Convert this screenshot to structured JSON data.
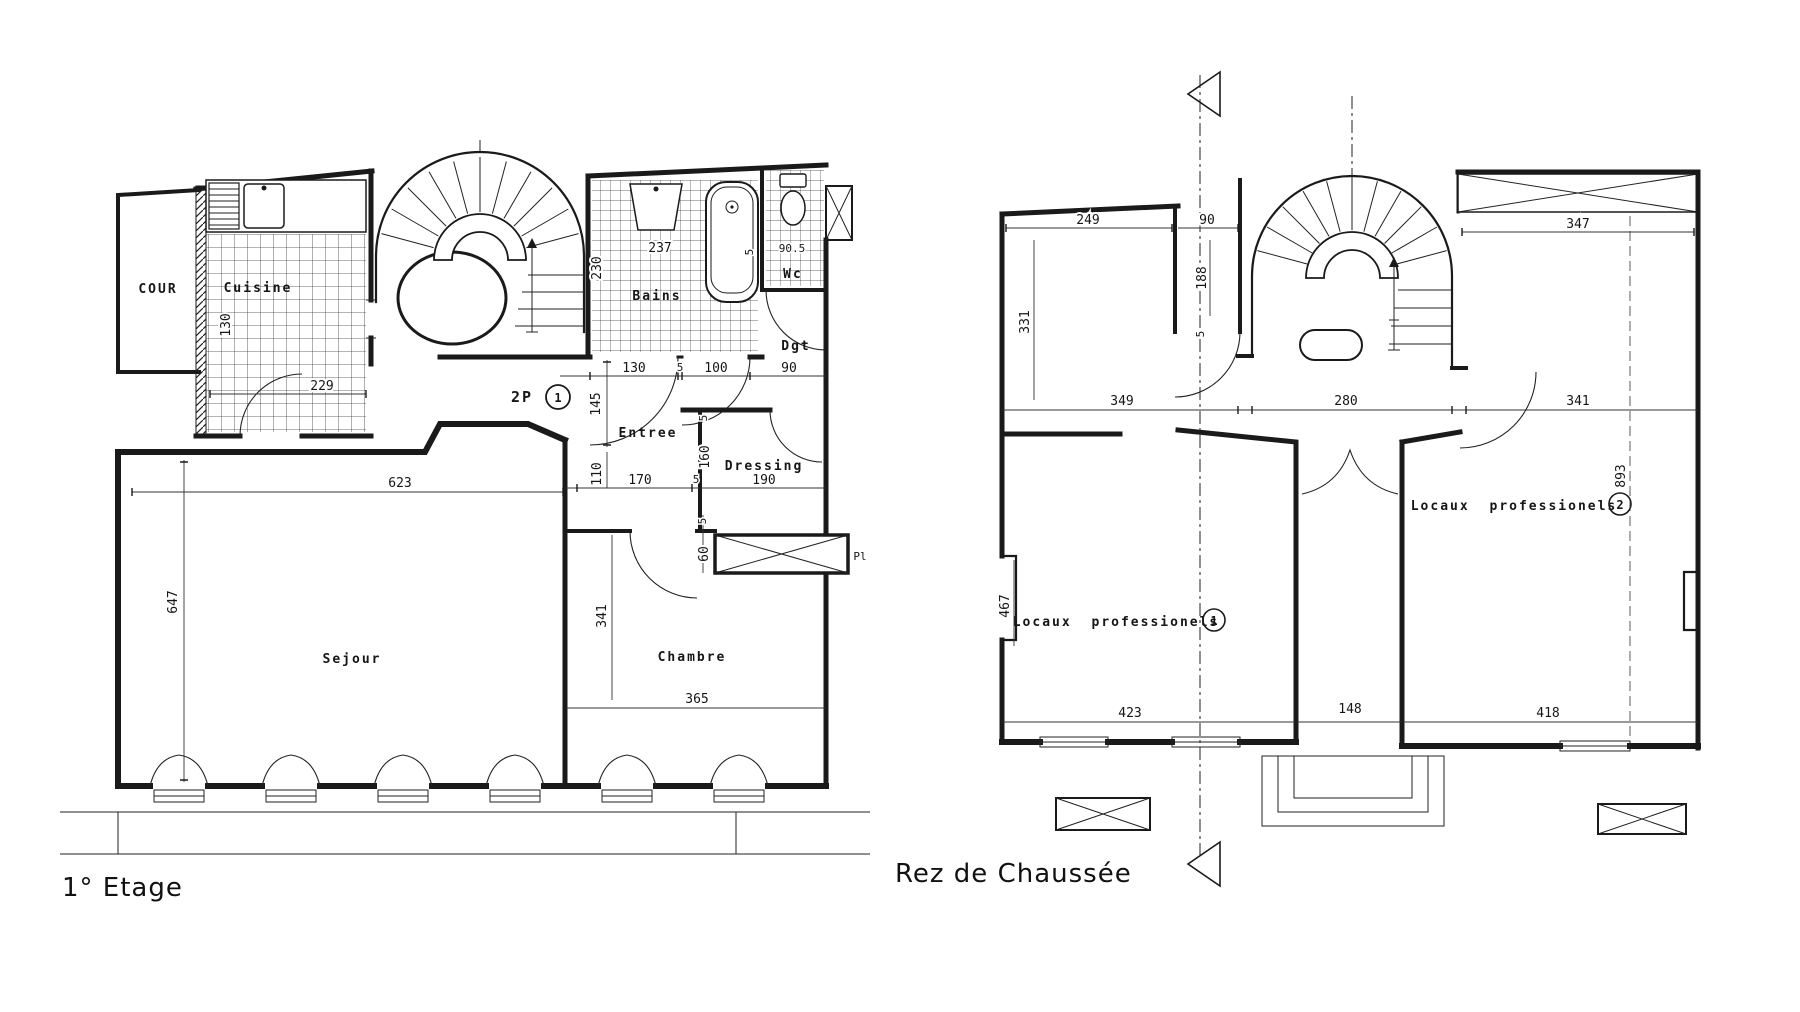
{
  "drawing": {
    "ink_color": "#1a1a1a",
    "paper_color": "#ffffff"
  },
  "etage": {
    "title": "1° Etage",
    "apartment": {
      "label": "2P",
      "number": "1"
    },
    "rooms": {
      "cour": "COUR",
      "cuisine": "Cuisine",
      "bains": "Bains",
      "wc": "Wc",
      "dgt": "Dgt",
      "entree": "Entree",
      "dressing": "Dressing",
      "sejour": "Sejour",
      "chambre": "Chambre",
      "placard": "Pl"
    },
    "dims": {
      "cuisine_depth": "130",
      "cuisine_width": "229",
      "bains_width": "237",
      "bains_depth": "230",
      "tub_edge": "5",
      "wc_width": "90.5",
      "stair_door": "130",
      "jamb_a": "5",
      "bains_door": "100",
      "dgt_width": "90",
      "entree_depth": "145",
      "hall_depth": "110",
      "hall_width": "170",
      "jamb_b": "5",
      "dressing_width": "190",
      "dressing_depth": "160",
      "jamb_c": "5",
      "placard_depth": "60",
      "sejour_width": "623",
      "sejour_depth": "647",
      "chambre_depth": "341",
      "chambre_width": "365"
    }
  },
  "rdc": {
    "title": "Rez de Chaussée",
    "rooms": {
      "locaux_1": "Locaux professionels",
      "locaux_1_num": "1",
      "locaux_2": "Locaux professionels",
      "locaux_2_num": "2"
    },
    "dims": {
      "top_left_width": "249",
      "top_left_depth": "331",
      "passage_width": "90",
      "passage_depth": "188",
      "jamb_a": "5",
      "span_left": "349",
      "span_center": "280",
      "span_right": "341",
      "top_right_width": "347",
      "depth_total": "893",
      "bay_left": "467",
      "bottom_left": "423",
      "bottom_center": "148",
      "bottom_right": "418"
    }
  }
}
